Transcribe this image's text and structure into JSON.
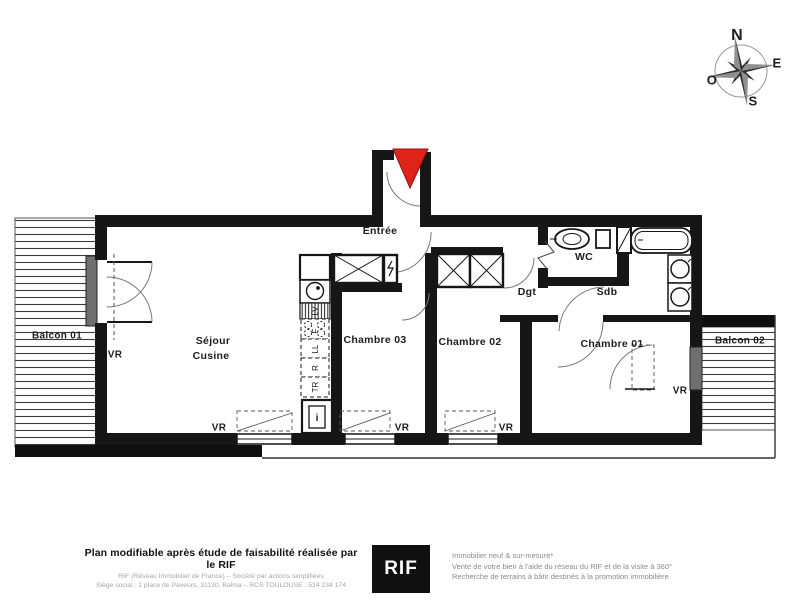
{
  "compass": {
    "north": "N",
    "east": "E",
    "south": "S",
    "west": "O"
  },
  "rooms": {
    "entrance": "Entrée",
    "living": "Séjour",
    "kitchen": "Cusine",
    "bedroom3": "Chambre 03",
    "bedroom2": "Chambre 02",
    "bedroom1": "Chambre 01",
    "wc": "WC",
    "hallway": "Dgt",
    "bathroom": "Sdb",
    "balcony1": "Balcon 01",
    "balcony2": "Balcon 02"
  },
  "markers": {
    "roller_shutter": "VR"
  },
  "kitchen_units": {
    "dishwasher": "LV",
    "hob": "F",
    "washing_machine": "LL",
    "fridge": "R",
    "dryer": "TR",
    "tech": "i"
  },
  "footer": {
    "title": "Plan modifiable après étude de faisabilité réalisée par le RIF",
    "company_line1": "RIF (Réseau Immobilier de France) – Société par actions simplifiées",
    "company_line2": "Siège social : 1 place de Paveurs, 31130, Balma – RCS TOULOUSE : 534 234 174",
    "logo_text": "RIF",
    "services": [
      "Immobilier neuf & sur-mesure*",
      "Vente de votre bien à l'aide du réseau du RIF et de la visite à 360°",
      "Recherche de terrains à bâtir destinés à la promotion immobilière"
    ]
  },
  "colors": {
    "wall": "#161616",
    "accent_red": "#e02318",
    "muted_text": "#9a9a9a"
  }
}
